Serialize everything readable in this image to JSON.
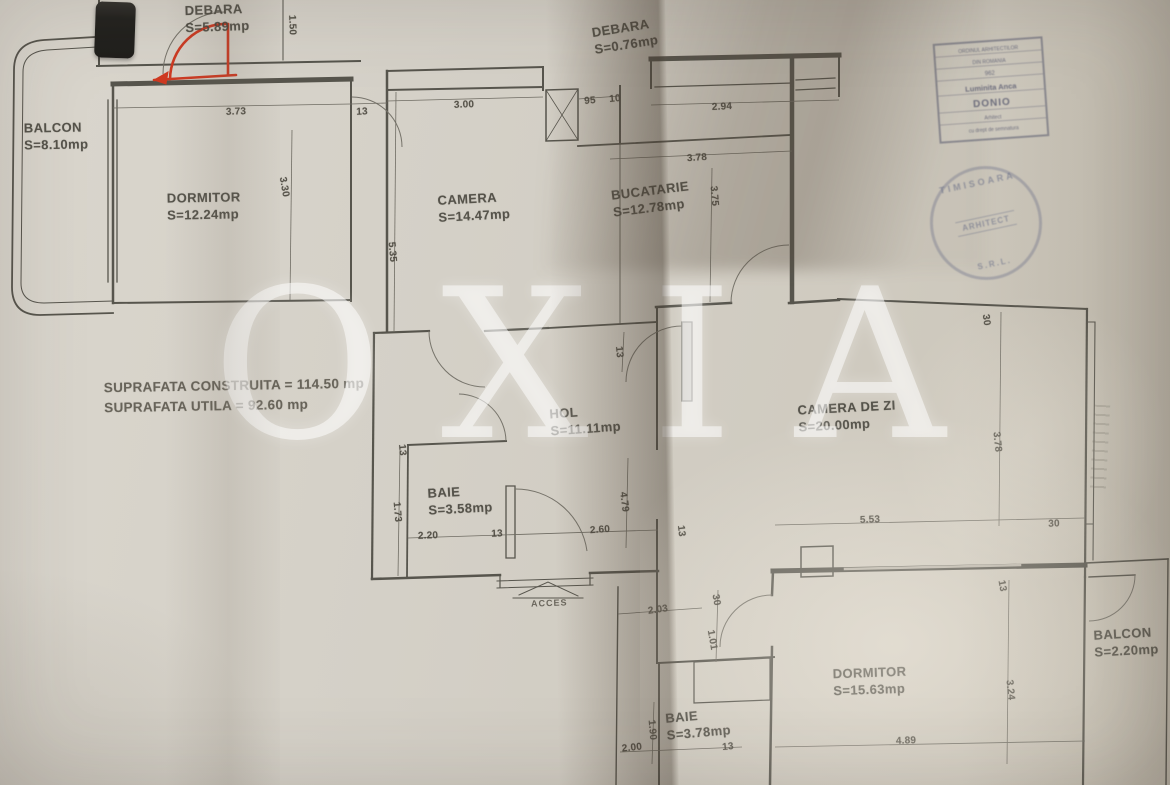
{
  "watermark": "OXIA",
  "summary": {
    "line1": "SUPRAFATA CONSTRUITA = 114.50 mp",
    "line2": "SUPRAFATA UTILA = 92.60 mp"
  },
  "access_label": "ACCES",
  "rooms": [
    {
      "name": "DEBARA",
      "area": "S=5.89mp",
      "x": 185,
      "y": 2,
      "rot": -2
    },
    {
      "name": "BALCON",
      "area": "S=8.10mp",
      "x": 24,
      "y": 120,
      "rot": -1
    },
    {
      "name": "DORMITOR",
      "area": "S=12.24mp",
      "x": 167,
      "y": 190,
      "rot": -1
    },
    {
      "name": "CAMERA",
      "area": "S=14.47mp",
      "x": 438,
      "y": 191,
      "rot": -3
    },
    {
      "name": "DEBARA",
      "area": "S=0.76mp",
      "x": 593,
      "y": 20,
      "rot": -9
    },
    {
      "name": "BUCATARIE",
      "area": "S=12.78mp",
      "x": 612,
      "y": 183,
      "rot": -7
    },
    {
      "name": "HOL",
      "area": "S=11.11mp",
      "x": 550,
      "y": 404,
      "rot": -4
    },
    {
      "name": "CAMERA DE ZI",
      "area": "S=20.00mp",
      "x": 798,
      "y": 400,
      "rot": -3
    },
    {
      "name": "BAIE",
      "area": "S=3.58mp",
      "x": 428,
      "y": 484,
      "rot": -3
    },
    {
      "name": "DORMITOR",
      "area": "S=15.63mp",
      "x": 833,
      "y": 665,
      "rot": -2
    },
    {
      "name": "BALCON",
      "area": "S=2.20mp",
      "x": 1094,
      "y": 626,
      "rot": -3
    },
    {
      "name": "BAIE",
      "area": "S=3.78mp",
      "x": 666,
      "y": 708,
      "rot": -5
    }
  ],
  "dims": [
    {
      "v": "1.50",
      "x": 292,
      "y": 25,
      "rot": 88
    },
    {
      "v": "3.73",
      "x": 236,
      "y": 112,
      "rot": -2
    },
    {
      "v": "13",
      "x": 362,
      "y": 112,
      "rot": -2
    },
    {
      "v": "3.00",
      "x": 464,
      "y": 105,
      "rot": -2
    },
    {
      "v": "95",
      "x": 590,
      "y": 101,
      "rot": -5
    },
    {
      "v": "10",
      "x": 615,
      "y": 99,
      "rot": -5
    },
    {
      "v": "2.94",
      "x": 722,
      "y": 107,
      "rot": -3
    },
    {
      "v": "3.78",
      "x": 697,
      "y": 158,
      "rot": -4
    },
    {
      "v": "3.75",
      "x": 714,
      "y": 196,
      "rot": 85
    },
    {
      "v": "3.30",
      "x": 284,
      "y": 187,
      "rot": 80
    },
    {
      "v": "5.35",
      "x": 392,
      "y": 252,
      "rot": 85
    },
    {
      "v": "13",
      "x": 619,
      "y": 352,
      "rot": 85
    },
    {
      "v": "30",
      "x": 986,
      "y": 320,
      "rot": 82
    },
    {
      "v": "3.78",
      "x": 997,
      "y": 442,
      "rot": 84
    },
    {
      "v": "13",
      "x": 402,
      "y": 450,
      "rot": 85
    },
    {
      "v": "1.73",
      "x": 397,
      "y": 512,
      "rot": 85
    },
    {
      "v": "2.20",
      "x": 428,
      "y": 536,
      "rot": -2
    },
    {
      "v": "13",
      "x": 497,
      "y": 534,
      "rot": -2
    },
    {
      "v": "2.60",
      "x": 600,
      "y": 530,
      "rot": -4
    },
    {
      "v": "4.79",
      "x": 624,
      "y": 502,
      "rot": 83
    },
    {
      "v": "13",
      "x": 681,
      "y": 531,
      "rot": 83
    },
    {
      "v": "5.53",
      "x": 870,
      "y": 520,
      "rot": -2
    },
    {
      "v": "30",
      "x": 1054,
      "y": 524,
      "rot": -2
    },
    {
      "v": "2.03",
      "x": 658,
      "y": 610,
      "rot": -8
    },
    {
      "v": "30",
      "x": 716,
      "y": 600,
      "rot": 80
    },
    {
      "v": "1.01",
      "x": 712,
      "y": 640,
      "rot": 80
    },
    {
      "v": "13",
      "x": 1002,
      "y": 586,
      "rot": 80
    },
    {
      "v": "1.90",
      "x": 652,
      "y": 730,
      "rot": 85
    },
    {
      "v": "2.00",
      "x": 632,
      "y": 748,
      "rot": -6
    },
    {
      "v": "13",
      "x": 728,
      "y": 747,
      "rot": -6
    },
    {
      "v": "4.89",
      "x": 906,
      "y": 741,
      "rot": -2
    },
    {
      "v": "3.24",
      "x": 1010,
      "y": 690,
      "rot": 84
    }
  ],
  "stamp_box": {
    "lines": [
      "ORDINUL ARHITECTILOR",
      "DIN ROMANIA",
      "962",
      "Luminita Anca",
      "DONIO",
      "Arhitect",
      "cu drept de semnatura"
    ]
  },
  "stamp_round": {
    "top": "TIMISOARA",
    "middle": "ARHITECT",
    "bottom": "S.R.L."
  },
  "colors": {
    "paper": "#d4d0c7",
    "ink": "#57554d",
    "red_annotation": "#cf3a22",
    "stamp_ink": "#3a3e5c"
  }
}
